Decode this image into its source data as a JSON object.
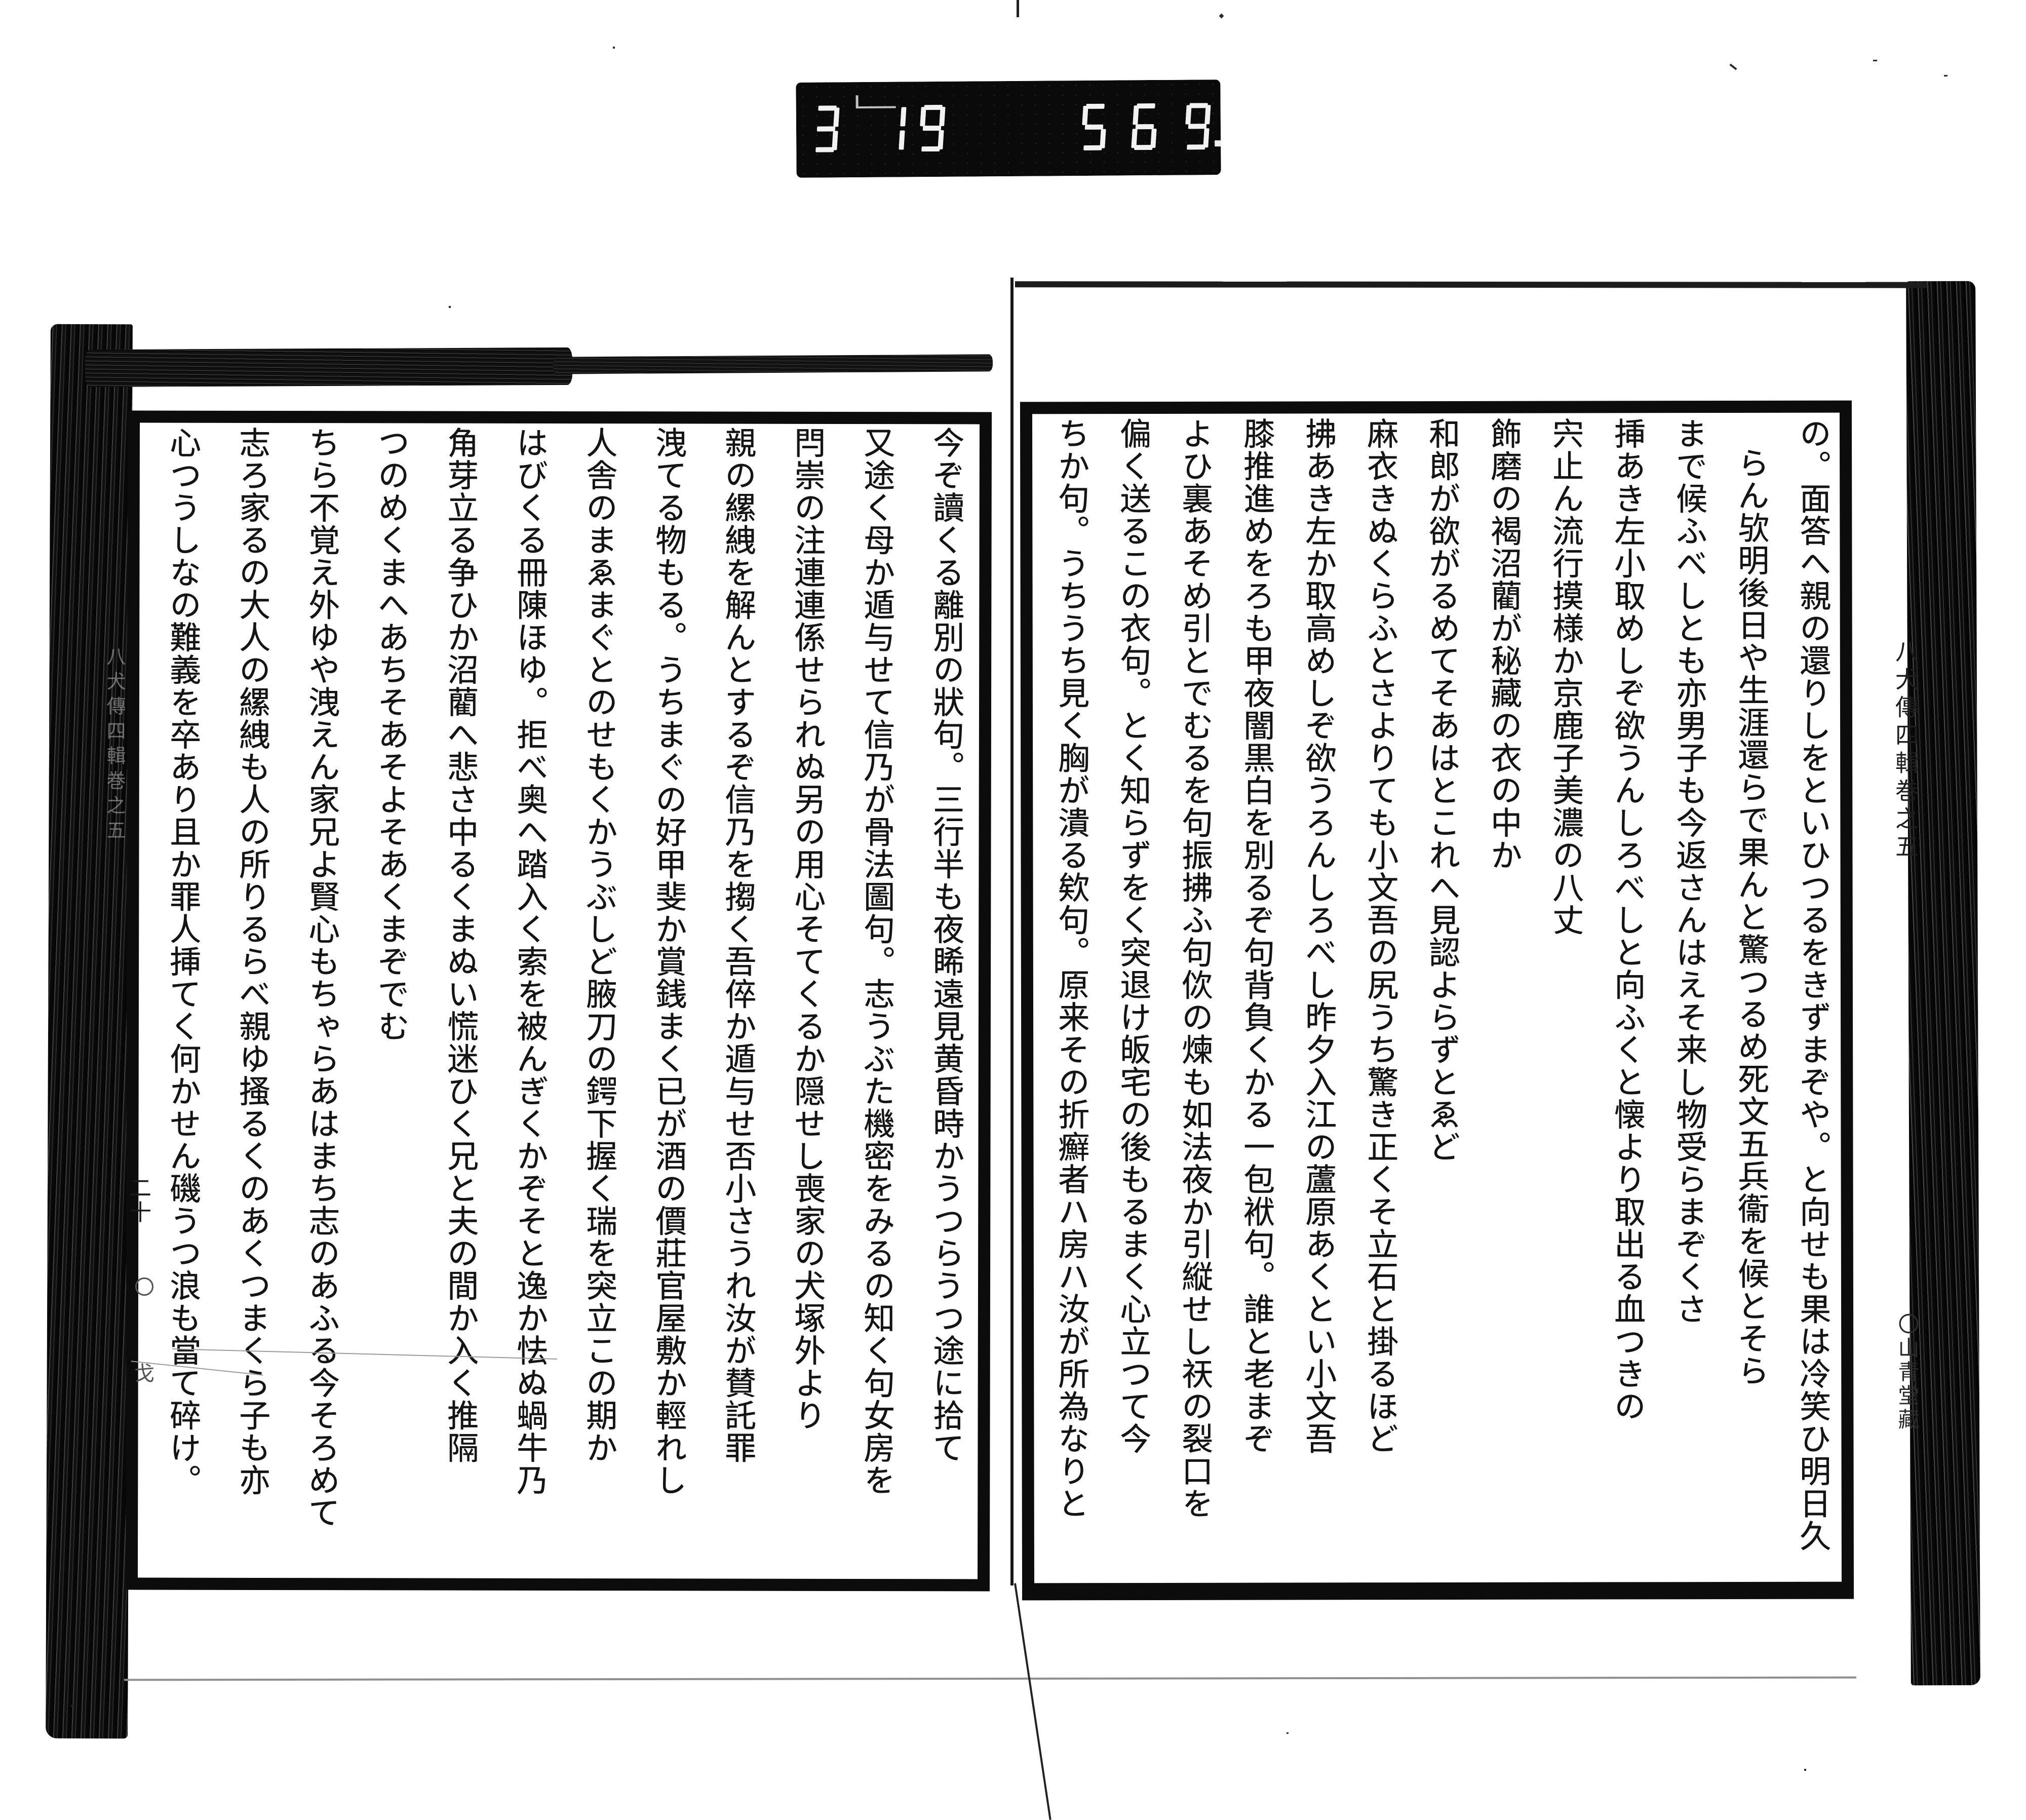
{
  "frame_counter": {
    "digits_left": "319",
    "digits_right": "569",
    "has_decimal_point": true,
    "digit_color": "#f2f2f2",
    "panel_color": "#0a0a0a"
  },
  "book": {
    "margin_title_right": "八犬傳四輯巻之五",
    "margin_publisher_right": "〇山青堂藏",
    "margin_title_left_faint": "八犬傳四輯巻之五",
    "page_number_left_margin": "二十",
    "left_margin_marks": "〇戈",
    "right_page": {
      "columns": [
        {
          "t": "の。面答へ親の還りしをといひつるをきずまぞや。と向せも果は冷笑ひ明日久",
          "pad": 0
        },
        {
          "t": "らん欤明後日や生涯還らで果んと驚つるめ死文五兵衞を候とそら",
          "pad": 1
        },
        {
          "t": "まで候ふべしとも亦男子も今返さんはえそ来し物受らまぞくさ",
          "pad": 0
        },
        {
          "t": "挿あき左小取めしぞ欲うんしろべしと向ふくと懐より取出る血つきの",
          "pad": 0
        },
        {
          "t": "宍止ん流行摸様か京鹿子美濃の八丈",
          "pad": 0
        },
        {
          "t": "飾磨の褐沼藺が秘藏の衣の中か",
          "pad": 0
        },
        {
          "t": "和郎が欲がるめてそあはとこれへ見認よらずとゑど",
          "pad": 0
        },
        {
          "t": "麻衣きぬくらふとさよりても小文吾の尻うち驚き正くそ立石と掛るほど",
          "pad": 0
        },
        {
          "t": "拂あき左か取高めしぞ欲うろんしろべし昨夕入江の蘆原あくとい小文吾",
          "pad": 0
        },
        {
          "t": "膝推進めをろも甲夜闇黒白を別るぞ句背負くかる一包袱句。誰と老まぞ",
          "pad": 0
        },
        {
          "t": "よひ裏あそめ引とでむるを句振拂ふ句佽の煉も如法夜か引縦せし祆の裂口を",
          "pad": 0
        },
        {
          "t": "偏く送るこの衣句。とく知らずをく突退け皈宅の後もるまく心立つて今",
          "pad": 0
        },
        {
          "t": "ちか句。うちうち見く胸が潰る欸句。原来その折癬者ハ房ハ汝が所為なりと",
          "pad": 0
        }
      ]
    },
    "left_page": {
      "columns": [
        {
          "t": "今ぞ讀くる離別の狀句。三行半も夜睎遠見黄昏時かうつらうつ途に拾て",
          "pad": 0
        },
        {
          "t": "又途く母か遁与せて信乃が骨法圖句。志うぶた機密をみるの知く句女房を",
          "pad": 0
        },
        {
          "t": "閂崇の注連連係せられぬ另の用心そてくるか隠せし喪家の犬塚外より",
          "pad": 0
        },
        {
          "t": "親の縲絏を解んとするぞ信乃を搊く吾倅か遁与せ否小さうれ汝が賛託罪",
          "pad": 0
        },
        {
          "t": "洩てる物もる。うちまぐの好甲斐か賞銭まく已が酒の價莊官屋敷か輕れし",
          "pad": 0
        },
        {
          "t": "人舎のまゑまぐとのせもくかうぶしど腋刀の鍔下握く瑞を突立この期か",
          "pad": 0
        },
        {
          "t": "はびくる冊陳ほゆ。拒べ奥へ踏入く索を被んぎくかぞそと逸か怯ぬ蝸牛乃",
          "pad": 0
        },
        {
          "t": "角芽立る争ひか沼藺へ悲さ中るくまぬい慌迷ひく兄と夫の間か入く推隔",
          "pad": 0
        },
        {
          "t": "つのめくまへあちそあそよそあくまぞでむ",
          "pad": 0
        },
        {
          "t": "ちら不覚え外ゆや洩えん家兄よ賢心もちゃらあはまち志のあふる今そろめて",
          "pad": 0
        },
        {
          "t": "志ろ家るの大人の縲絏も人の所りるらべ親ゆ搔るくのあくつまくら子も亦",
          "pad": 0
        },
        {
          "t": "心つうしなの難義を卒あり且か罪人挿てく何かせん磯うつ浪も當て碎け。",
          "pad": 0
        }
      ]
    }
  }
}
